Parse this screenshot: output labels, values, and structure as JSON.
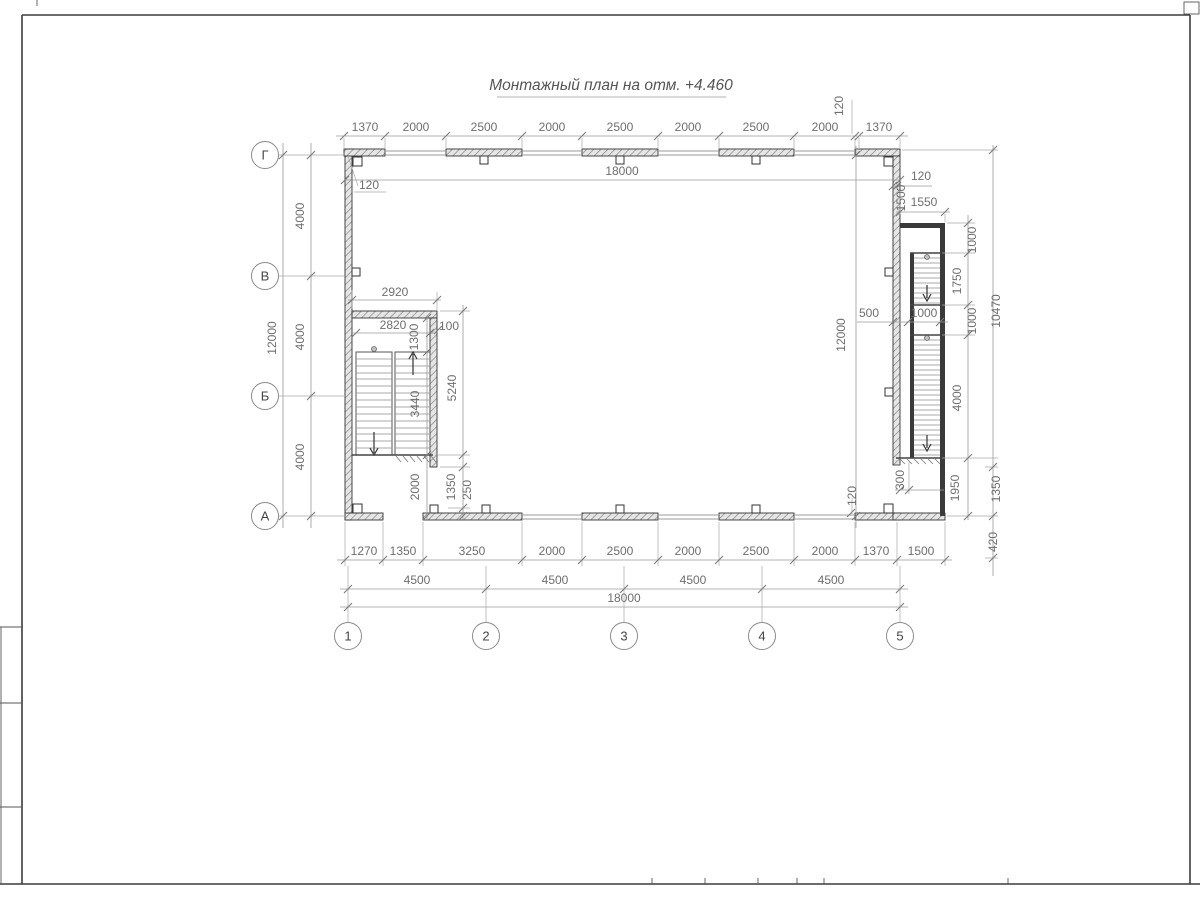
{
  "title": "Монтажный план на отм. +4.460",
  "axes": {
    "rows": [
      "Г",
      "В",
      "Б",
      "А"
    ],
    "cols": [
      "1",
      "2",
      "3",
      "4",
      "5"
    ]
  },
  "dims": {
    "top": [
      "1370",
      "2000",
      "2500",
      "2000",
      "2500",
      "2000",
      "2500",
      "2000",
      "1370"
    ],
    "top120": "120",
    "top18000": "18000",
    "wall120_topleft": "120",
    "left12000": "12000",
    "left4000": [
      "4000",
      "4000",
      "4000"
    ],
    "bottom": [
      "1270",
      "1350",
      "3250",
      "2000",
      "2500",
      "2000",
      "2500",
      "2000",
      "1370",
      "1500"
    ],
    "spans4500": [
      "4500",
      "4500",
      "4500",
      "4500"
    ],
    "bottom18000": "18000",
    "right": {
      "r120top": "120",
      "r1500": "1500",
      "r1550": "1550",
      "r1000a": "1000",
      "r1750": "1750",
      "r1000b": "1000",
      "r10470": "10470",
      "r500": "500",
      "r1000c": "1000",
      "r12000": "12000",
      "r4000": "4000",
      "r1950": "1950",
      "r1350": "1350",
      "r300": "300",
      "r120bottom": "120",
      "r420": "420"
    },
    "stair": {
      "s2920": "2920",
      "s2820": "2820",
      "s1300": "1300",
      "s100": "100",
      "s3440": "3440",
      "s5240": "5240",
      "s2000": "2000",
      "s1350": "1350",
      "s250": "250"
    }
  }
}
